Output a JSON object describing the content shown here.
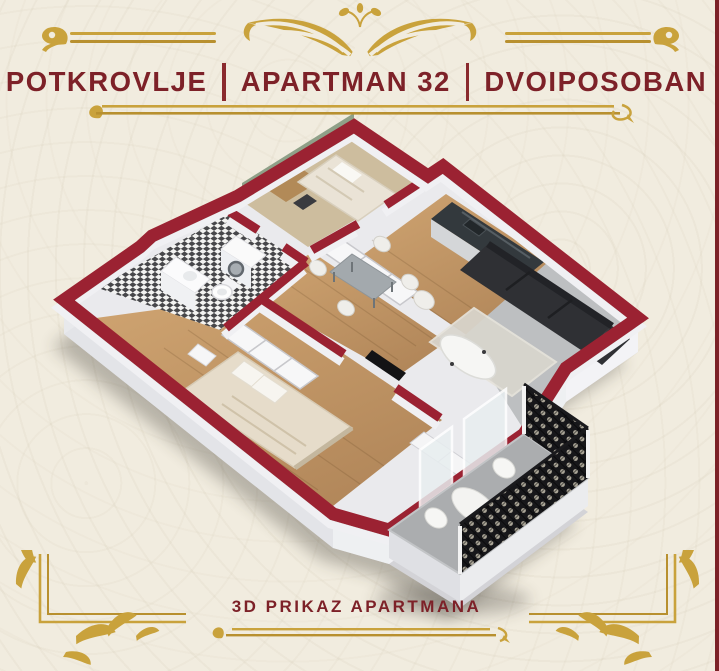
{
  "poster": {
    "background_color": "#f1ecdf",
    "right_edge_color": "#7b2127",
    "header": {
      "title_segments": [
        "POTKROVLJE",
        "APARTMAN 32",
        "DVOIPOSOBAN"
      ],
      "text_color": "#7d2128",
      "ornament": "gold-art-deco-wings",
      "gold_color": "#c9a23c"
    },
    "footer": {
      "caption": "3D PRIKAZ APARTMANA",
      "text_color": "#7d2128"
    },
    "floor_plan": {
      "view": "3d-isometric-cutaway",
      "wall_cut_color": "#9b2430",
      "wall_face_color": "#eef0f2",
      "wood_floor_color": "#c49a68",
      "tile_floor_color": "#bcbec0",
      "bathroom_tile": "black-white-checker",
      "accent_wall_color": "#8fa088",
      "sofa_color": "#2f3034",
      "railing_color": "#17171a",
      "rooms": [
        "bedroom-small",
        "bathroom",
        "hallway-closets",
        "kitchen-dining",
        "living-room",
        "bedroom-main",
        "balcony"
      ]
    }
  }
}
